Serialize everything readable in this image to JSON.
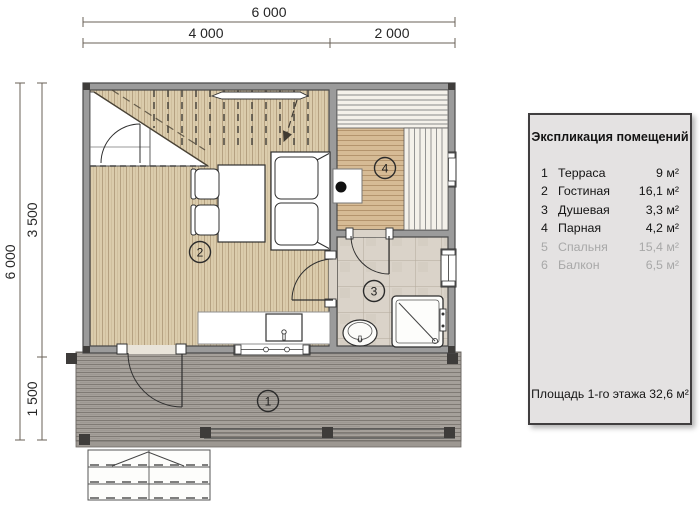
{
  "dimensions": {
    "top_total": "6 000",
    "top_left": "4 000",
    "top_right": "2 000",
    "left_total": "6 000",
    "left_upper": "3 500",
    "left_lower": "1 500"
  },
  "plan": {
    "room_numbers": {
      "terrace": "1",
      "living_room": "2",
      "shower": "3",
      "sauna": "4"
    }
  },
  "legend": {
    "title": "Экспликация помещений",
    "rows": [
      {
        "num": "1",
        "name": "Терраса",
        "area": "9 м²"
      },
      {
        "num": "2",
        "name": "Гостиная",
        "area": "16,1 м²"
      },
      {
        "num": "3",
        "name": "Душевая",
        "area": "3,3 м²"
      },
      {
        "num": "4",
        "name": "Парная",
        "area": "4,2 м²"
      },
      {
        "num": "5",
        "name": "Спальня",
        "area": "15,4 м²"
      },
      {
        "num": "6",
        "name": "Балкон",
        "area": "6,5 м²"
      }
    ],
    "footer": "Площадь 1-го этажа 32,6 м²"
  },
  "colors": {
    "wall": "#9b9b9b",
    "wall_edge": "#4a4a4a",
    "wood_floor": "#dbccac",
    "sauna_floor": "#d6bb95",
    "tile_floor": "#dad3c9",
    "deck": "#a5a09a",
    "panel_bg": "#e4e2e2",
    "panel_border": "#403e3f",
    "inactive_text": "#a8a8a8"
  }
}
